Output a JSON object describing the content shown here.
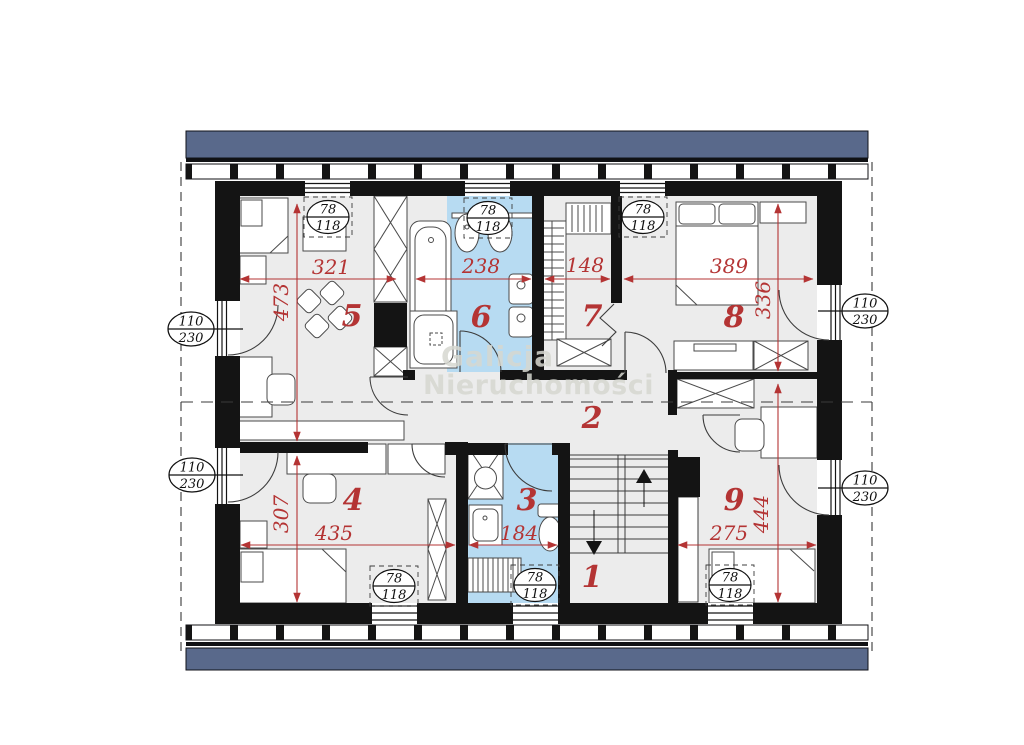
{
  "watermark": {
    "line1": "Galicja",
    "line2": "Nieruchomości"
  },
  "room_numbers": {
    "r1": "1",
    "r2": "2",
    "r3": "3",
    "r4": "4",
    "r5": "5",
    "r6": "6",
    "r7": "7",
    "r8": "8",
    "r9": "9"
  },
  "dimensions_cm": {
    "top": [
      "321",
      "238",
      "148",
      "389"
    ],
    "bottom": [
      "435",
      "184",
      "275"
    ],
    "left": [
      "473",
      "307"
    ],
    "right": [
      "336",
      "444"
    ]
  },
  "window_tags": {
    "small_top": "78",
    "small_bottom": "118",
    "large_top": "110",
    "large_bottom": "230"
  },
  "colors": {
    "wall": "#141414",
    "floor": "#ececec",
    "bathroom_floor": "#b7dbf2",
    "dimension_red": "#b43434",
    "roof_bar": "#59698b",
    "watermark_gray": "#d6d7d0"
  }
}
